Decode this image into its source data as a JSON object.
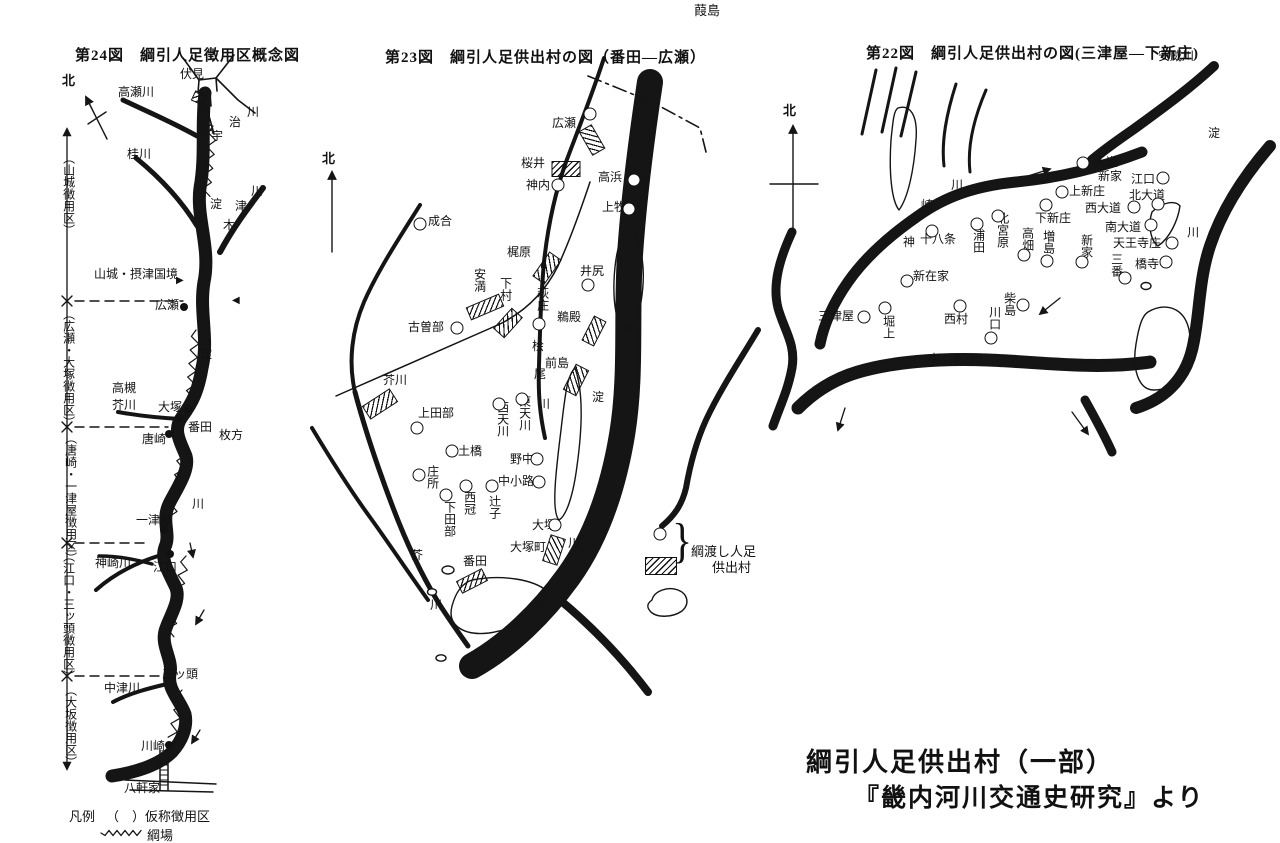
{
  "caption": {
    "line1": "綱引人足供出村（一部）",
    "line2": "『畿内河川交通史研究』より"
  },
  "legend_main": {
    "title": "凡例",
    "item1": "（　）仮称徴用区",
    "item2": "綱場"
  },
  "legend23": {
    "bracket": "}",
    "line1": "綱渡し人足",
    "line2": "供出村",
    "island_label": "葭島"
  },
  "map24": {
    "title": "第24図　綱引人足徴用区概念図",
    "north": "北",
    "labels": [
      {
        "t": "伏見",
        "x": 180,
        "y": 68
      },
      {
        "t": "高瀬川",
        "x": 118,
        "y": 86
      },
      {
        "t": "桂川",
        "x": 127,
        "y": 148
      },
      {
        "t": "宇",
        "x": 211,
        "y": 130
      },
      {
        "t": "治",
        "x": 229,
        "y": 116
      },
      {
        "t": "川",
        "x": 247,
        "y": 106
      },
      {
        "t": "淀",
        "x": 210,
        "y": 198
      },
      {
        "t": "木",
        "x": 223,
        "y": 219
      },
      {
        "t": "津",
        "x": 235,
        "y": 200
      },
      {
        "t": "川",
        "x": 251,
        "y": 185
      },
      {
        "t": "（山城徴用区）",
        "x": 62,
        "y": 152,
        "v": 1
      },
      {
        "t": "山城・摂津国境",
        "x": 94,
        "y": 268
      },
      {
        "t": "▶",
        "x": 176,
        "y": 276,
        "fs": 10
      },
      {
        "t": "◀",
        "x": 232,
        "y": 296,
        "fs": 10
      },
      {
        "t": "広瀬",
        "x": 155,
        "y": 299
      },
      {
        "t": "（広瀬・大塚徴用区）",
        "x": 62,
        "y": 308,
        "v": 1
      },
      {
        "t": "淀",
        "x": 200,
        "y": 348
      },
      {
        "t": "高槻",
        "x": 112,
        "y": 382
      },
      {
        "t": "芥川",
        "x": 112,
        "y": 399
      },
      {
        "t": "大塚",
        "x": 158,
        "y": 401
      },
      {
        "t": "番田",
        "x": 188,
        "y": 421
      },
      {
        "t": "唐崎",
        "x": 142,
        "y": 433
      },
      {
        "t": "枚方",
        "x": 219,
        "y": 429
      },
      {
        "t": "（唐崎・一津屋徴用区）",
        "x": 64,
        "y": 432,
        "v": 1
      },
      {
        "t": "一津屋",
        "x": 136,
        "y": 514
      },
      {
        "t": "川",
        "x": 192,
        "y": 498
      },
      {
        "t": "神崎川",
        "x": 95,
        "y": 557
      },
      {
        "t": "江口",
        "x": 153,
        "y": 561
      },
      {
        "t": "（江口・三ッ頭徴用区）",
        "x": 62,
        "y": 550,
        "v": 1
      },
      {
        "t": "三ッ頭",
        "x": 162,
        "y": 668
      },
      {
        "t": "中津川",
        "x": 104,
        "y": 682
      },
      {
        "t": "（大坂徴用区）",
        "x": 64,
        "y": 684,
        "v": 1
      },
      {
        "t": "川崎",
        "x": 141,
        "y": 740
      },
      {
        "t": "八軒家",
        "x": 124,
        "y": 782
      }
    ],
    "markers": [
      {
        "k": "h",
        "x": 199,
        "y": 98,
        "w": 11,
        "h": 9,
        "r": 25
      },
      {
        "k": "d",
        "x": 184,
        "y": 307
      },
      {
        "k": "d",
        "x": 188,
        "y": 409
      },
      {
        "k": "d",
        "x": 179,
        "y": 418
      },
      {
        "k": "d",
        "x": 169,
        "y": 434
      },
      {
        "k": "d",
        "x": 164,
        "y": 530
      },
      {
        "k": "d",
        "x": 170,
        "y": 554
      },
      {
        "k": "d",
        "x": 169,
        "y": 745
      }
    ]
  },
  "map23": {
    "title": "第23図　綱引人足供出村の図（番田—広瀬）",
    "north": "北",
    "labels": [
      {
        "t": "広瀬",
        "x": 552,
        "y": 117
      },
      {
        "t": "桜井",
        "x": 521,
        "y": 157
      },
      {
        "t": "神内",
        "x": 526,
        "y": 179
      },
      {
        "t": "高浜",
        "x": 598,
        "y": 171
      },
      {
        "t": "上牧",
        "x": 602,
        "y": 201
      },
      {
        "t": "成合",
        "x": 428,
        "y": 215
      },
      {
        "t": "梶原",
        "x": 507,
        "y": 246
      },
      {
        "t": "安満",
        "x": 473,
        "y": 268,
        "v": 1
      },
      {
        "t": "下村",
        "x": 499,
        "y": 277,
        "v": 1
      },
      {
        "t": "古曽部",
        "x": 408,
        "y": 321
      },
      {
        "t": "萩庄",
        "x": 536,
        "y": 287,
        "v": 1
      },
      {
        "t": "桧",
        "x": 532,
        "y": 340
      },
      {
        "t": "尾",
        "x": 534,
        "y": 368
      },
      {
        "t": "川",
        "x": 538,
        "y": 398
      },
      {
        "t": "井尻",
        "x": 580,
        "y": 265
      },
      {
        "t": "鵜殿",
        "x": 557,
        "y": 311
      },
      {
        "t": "前島",
        "x": 545,
        "y": 357
      },
      {
        "t": "淀",
        "x": 592,
        "y": 391
      },
      {
        "t": "川",
        "x": 568,
        "y": 537
      },
      {
        "t": "芥川",
        "x": 383,
        "y": 374
      },
      {
        "t": "上田部",
        "x": 418,
        "y": 407
      },
      {
        "t": "西天川",
        "x": 496,
        "y": 401,
        "v": 1
      },
      {
        "t": "東天川",
        "x": 518,
        "y": 395,
        "v": 1
      },
      {
        "t": "土橋",
        "x": 458,
        "y": 445
      },
      {
        "t": "野中",
        "x": 510,
        "y": 453
      },
      {
        "t": "庄所",
        "x": 426,
        "y": 465,
        "v": 1
      },
      {
        "t": "中小路",
        "x": 498,
        "y": 475
      },
      {
        "t": "西冠",
        "x": 463,
        "y": 491,
        "v": 1
      },
      {
        "t": "辻子",
        "x": 488,
        "y": 495,
        "v": 1
      },
      {
        "t": "下田部",
        "x": 443,
        "y": 501,
        "v": 1
      },
      {
        "t": "大塚",
        "x": 532,
        "y": 519
      },
      {
        "t": "大塚町",
        "x": 510,
        "y": 541
      },
      {
        "t": "芥",
        "x": 411,
        "y": 549
      },
      {
        "t": "川",
        "x": 430,
        "y": 599
      },
      {
        "t": "番田",
        "x": 463,
        "y": 555
      }
    ],
    "markers": [
      {
        "k": "c",
        "x": 590,
        "y": 114
      },
      {
        "k": "h",
        "x": 592,
        "y": 140,
        "w": 26,
        "h": 13,
        "r": 60
      },
      {
        "k": "h",
        "x": 566,
        "y": 169,
        "w": 27,
        "h": 14,
        "r": 0
      },
      {
        "k": "c",
        "x": 558,
        "y": 185
      },
      {
        "k": "c",
        "x": 634,
        "y": 180
      },
      {
        "k": "c",
        "x": 629,
        "y": 209
      },
      {
        "k": "c",
        "x": 420,
        "y": 224
      },
      {
        "k": "h",
        "x": 547,
        "y": 268,
        "w": 28,
        "h": 13,
        "r": -55
      },
      {
        "k": "h",
        "x": 485,
        "y": 307,
        "w": 34,
        "h": 12,
        "r": -23
      },
      {
        "k": "h",
        "x": 508,
        "y": 323,
        "w": 26,
        "h": 13,
        "r": -48
      },
      {
        "k": "c",
        "x": 457,
        "y": 328
      },
      {
        "k": "c",
        "x": 539,
        "y": 324
      },
      {
        "k": "c",
        "x": 588,
        "y": 285
      },
      {
        "k": "h",
        "x": 594,
        "y": 331,
        "w": 26,
        "h": 12,
        "r": -63
      },
      {
        "k": "h",
        "x": 576,
        "y": 380,
        "w": 27,
        "h": 13,
        "r": -63
      },
      {
        "k": "h",
        "x": 380,
        "y": 404,
        "w": 31,
        "h": 14,
        "r": -33
      },
      {
        "k": "c",
        "x": 417,
        "y": 428
      },
      {
        "k": "c",
        "x": 499,
        "y": 404
      },
      {
        "k": "c",
        "x": 522,
        "y": 399
      },
      {
        "k": "c",
        "x": 452,
        "y": 451
      },
      {
        "k": "c",
        "x": 537,
        "y": 459
      },
      {
        "k": "c",
        "x": 419,
        "y": 475
      },
      {
        "k": "c",
        "x": 539,
        "y": 482
      },
      {
        "k": "c",
        "x": 466,
        "y": 486
      },
      {
        "k": "c",
        "x": 492,
        "y": 486
      },
      {
        "k": "c",
        "x": 446,
        "y": 495
      },
      {
        "k": "c",
        "x": 555,
        "y": 525
      },
      {
        "k": "h",
        "x": 554,
        "y": 550,
        "w": 26,
        "h": 14,
        "r": -72
      },
      {
        "k": "h",
        "x": 472,
        "y": 581,
        "w": 27,
        "h": 12,
        "r": -27
      },
      {
        "k": "c",
        "x": 660,
        "y": 534
      },
      {
        "k": "h",
        "x": 661,
        "y": 566,
        "w": 30,
        "h": 16,
        "r": 0
      }
    ]
  },
  "map22": {
    "title": "第22図　綱引人足供出村の図(三津屋—下新庄)",
    "north": "北",
    "labels": [
      {
        "t": "安威川",
        "x": 1158,
        "y": 50
      },
      {
        "t": "淀",
        "x": 1208,
        "y": 127
      },
      {
        "t": "川",
        "x": 1186,
        "y": 226,
        "v": 1
      },
      {
        "t": "神",
        "x": 903,
        "y": 236
      },
      {
        "t": "崎",
        "x": 921,
        "y": 199
      },
      {
        "t": "川",
        "x": 951,
        "y": 179
      },
      {
        "t": "大道",
        "x": 1094,
        "y": 156
      },
      {
        "t": "新家",
        "x": 1098,
        "y": 170
      },
      {
        "t": "江口",
        "x": 1131,
        "y": 173
      },
      {
        "t": "上新庄",
        "x": 1069,
        "y": 185
      },
      {
        "t": "北大道",
        "x": 1129,
        "y": 189
      },
      {
        "t": "西大道",
        "x": 1085,
        "y": 202
      },
      {
        "t": "下新庄",
        "x": 1035,
        "y": 212
      },
      {
        "t": "南大道",
        "x": 1105,
        "y": 221
      },
      {
        "t": "天王寺庄",
        "x": 1113,
        "y": 237
      },
      {
        "t": "橋寺",
        "x": 1135,
        "y": 258
      },
      {
        "t": "三番",
        "x": 1110,
        "y": 253,
        "v": 1
      },
      {
        "t": "新家",
        "x": 1080,
        "y": 234,
        "v": 1
      },
      {
        "t": "増島",
        "x": 1042,
        "y": 230,
        "v": 1
      },
      {
        "t": "高畑",
        "x": 1021,
        "y": 227,
        "v": 1
      },
      {
        "t": "北宮原",
        "x": 996,
        "y": 212,
        "v": 1
      },
      {
        "t": "浦田",
        "x": 972,
        "y": 229,
        "v": 1
      },
      {
        "t": "十八条",
        "x": 920,
        "y": 233
      },
      {
        "t": "新在家",
        "x": 913,
        "y": 270
      },
      {
        "t": "三津屋",
        "x": 818,
        "y": 310
      },
      {
        "t": "堀上",
        "x": 882,
        "y": 315,
        "v": 1
      },
      {
        "t": "西村",
        "x": 944,
        "y": 313
      },
      {
        "t": "柴島",
        "x": 1003,
        "y": 292,
        "v": 1
      },
      {
        "t": "川口",
        "x": 988,
        "y": 306,
        "v": 1
      },
      {
        "t": "中津川",
        "x": 928,
        "y": 353,
        "ls": 9
      }
    ],
    "markers": [
      {
        "k": "c",
        "x": 1083,
        "y": 163
      },
      {
        "k": "c",
        "x": 1163,
        "y": 178
      },
      {
        "k": "c",
        "x": 1062,
        "y": 192
      },
      {
        "k": "c",
        "x": 1158,
        "y": 204
      },
      {
        "k": "c",
        "x": 1134,
        "y": 207
      },
      {
        "k": "c",
        "x": 1046,
        "y": 205
      },
      {
        "k": "c",
        "x": 1151,
        "y": 225
      },
      {
        "k": "c",
        "x": 1172,
        "y": 243
      },
      {
        "k": "c",
        "x": 1166,
        "y": 262
      },
      {
        "k": "c",
        "x": 1125,
        "y": 278
      },
      {
        "k": "c",
        "x": 1082,
        "y": 262
      },
      {
        "k": "c",
        "x": 1047,
        "y": 261
      },
      {
        "k": "c",
        "x": 1024,
        "y": 255
      },
      {
        "k": "c",
        "x": 998,
        "y": 216
      },
      {
        "k": "c",
        "x": 977,
        "y": 224
      },
      {
        "k": "c",
        "x": 932,
        "y": 231
      },
      {
        "k": "c",
        "x": 907,
        "y": 281
      },
      {
        "k": "c",
        "x": 864,
        "y": 317
      },
      {
        "k": "c",
        "x": 885,
        "y": 308
      },
      {
        "k": "c",
        "x": 960,
        "y": 306
      },
      {
        "k": "c",
        "x": 1023,
        "y": 305
      },
      {
        "k": "c",
        "x": 991,
        "y": 338
      }
    ]
  }
}
